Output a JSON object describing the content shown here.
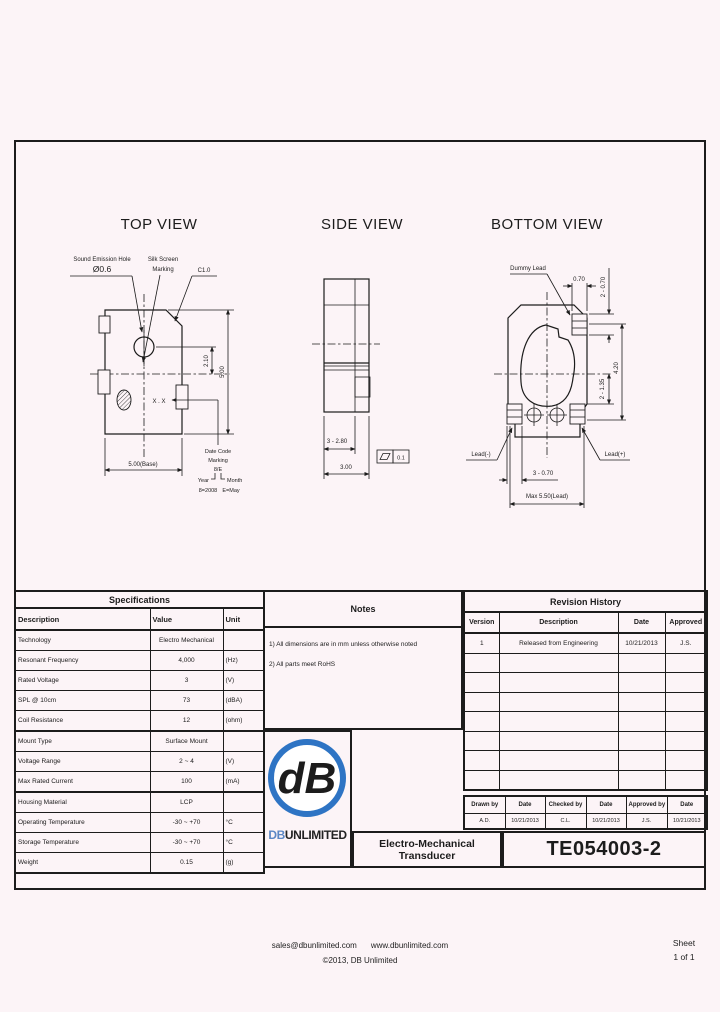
{
  "page": {
    "footer_email": "sales@dbunlimited.com",
    "footer_web": "www.dbunlimited.com",
    "footer_copyright": "©2013, DB Unlimited",
    "sheet_label": "Sheet",
    "sheet_number": "1 of 1"
  },
  "colors": {
    "background": "#fcf4f7",
    "line": "#1c1c1c",
    "logo_blue": "#2e74c4"
  },
  "views": {
    "top": {
      "title": "TOP VIEW",
      "sound_hole_label": "Sound Emission Hole",
      "sound_hole_dia": "Ø0.6",
      "silkscreen_label_1": "Silk Screen",
      "silkscreen_label_2": "Marking",
      "chamfer_label": "C1.0",
      "marking_text": "X . X",
      "datecode_1": "Date Code",
      "datecode_2": "Marking",
      "datecode_3": "8/E",
      "datecode_year": "Year",
      "datecode_month": "Month",
      "datecode_year_example": "8=2008",
      "datecode_month_example": "E=May",
      "dim_base": "5.00(Base)",
      "dim_height": "5.00",
      "dim_hole": "2.10"
    },
    "side": {
      "title": "SIDE VIEW",
      "dim_pad": "3 - 2.80",
      "dim_width": "3.00",
      "flatness_value": "0.1"
    },
    "bottom": {
      "title": "BOTTOM VIEW",
      "dummy_lead_label": "Dummy Lead",
      "dim_pad_width": "0.70",
      "dim_pads_right": "2 - 0.70",
      "dim_span": "4.20",
      "dim_inner": "2 - 1.35",
      "lead_neg_label": "Lead(-)",
      "lead_pos_label": "Lead(+)",
      "dim_pads_bottom": "3 - 0.70",
      "dim_lead_max": "Max 5.50(Lead)"
    }
  },
  "specifications": {
    "title": "Specifications",
    "columns": [
      "Description",
      "Value",
      "Unit"
    ],
    "rows": [
      [
        "Technology",
        "Electro Mechanical",
        ""
      ],
      [
        "Resonant Frequency",
        "4,000",
        "(Hz)"
      ],
      [
        "Rated Voltage",
        "3",
        "(V)"
      ],
      [
        "SPL @ 10cm",
        "73",
        "(dBA)"
      ],
      [
        "Coil Resistance",
        "12",
        "(ohm)"
      ],
      [
        "Mount Type",
        "Surface Mount",
        ""
      ],
      [
        "Voltage Range",
        "2 ~ 4",
        "(V)"
      ],
      [
        "Max Rated Current",
        "100",
        "(mA)"
      ],
      [
        "Housing Material",
        "LCP",
        ""
      ],
      [
        "Operating Temperature",
        "-30 ~ +70",
        "°C"
      ],
      [
        "Storage Temperature",
        "-30 ~ +70",
        "°C"
      ],
      [
        "Weight",
        "0.15",
        "(g)"
      ]
    ]
  },
  "notes": {
    "title": "Notes",
    "items": [
      "1) All dimensions are in mm unless otherwise noted",
      "2) All parts meet RoHS"
    ]
  },
  "revision_history": {
    "title": "Revision History",
    "columns": [
      "Version",
      "Description",
      "Date",
      "Approved"
    ],
    "rows": [
      [
        "1",
        "Released from Engineering",
        "10/21/2013",
        "J.S."
      ]
    ]
  },
  "title_block": {
    "logo_monogram": "dB",
    "logo_db": "DB",
    "logo_unlimited": "UNLIMITED",
    "product_title": "Electro-Mechanical Transducer",
    "part_number": "TE054003-2",
    "signoff": {
      "drawn_label": "Drawn by",
      "date_label": "Date",
      "checked_label": "Checked by",
      "approved_label": "Approved by",
      "drawn_by": "A.D.",
      "drawn_date": "10/21/2013",
      "checked_by": "C.L.",
      "checked_date": "10/21/2013",
      "approved_by": "J.S.",
      "approved_date": "10/21/2013"
    }
  }
}
